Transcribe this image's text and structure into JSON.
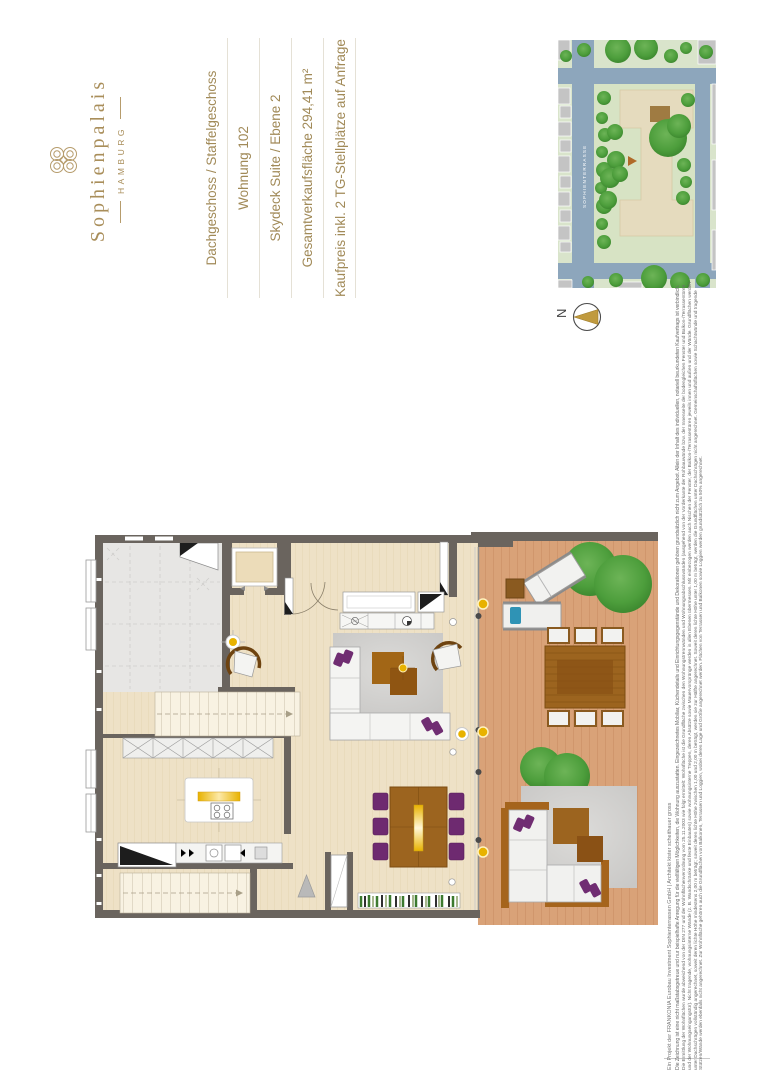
{
  "branding": {
    "name": "Sophienpalais",
    "city": "HAMBURG",
    "brand_color": "#a98e5a",
    "ornament_icon": "scroll-quatrefoil-monogram"
  },
  "info_panel": {
    "orientation": "rotated-90-ccw",
    "lines": [
      "Dachgeschoss / Staffelgeschoss",
      "Wohnung 102",
      "Skydeck Suite / Ebene 2",
      "Gesamtverkaufsfläche 294,41 m²",
      "Kaufpreis inkl. 2 TG-Stellplätze auf Anfrage"
    ]
  },
  "site_map": {
    "street_label": "SOPHIENTERRASSE",
    "marker_icon": "location-triangle",
    "colors": {
      "lawn": "#d9e4cb",
      "street": "#8da6bc",
      "building_gray": "#c4c4c4",
      "building_main": "#e5dbbe",
      "unit_highlight": "#9f7b42",
      "tree": "#4d9e3c"
    }
  },
  "compass": {
    "north_label": "N",
    "needle_color": "#c09a3e"
  },
  "floor_plan": {
    "colors": {
      "wall": "#6a645e",
      "floor_wood": "#eee1c6",
      "room_gray": "#e7e6e4",
      "terrace_deck": "#d9a278",
      "furniture_brown": "#9c641f",
      "accent_purple": "#702d72",
      "accent_gold": "#e8b200",
      "rug_gray": "#d6d5d3"
    },
    "elements": [
      "elevator",
      "upper-staircase",
      "lower-staircase",
      "wardrobe-row",
      "kitchen-island-with-cooktop",
      "kitchen-counter",
      "sofa-with-rug-and-coffee-table",
      "lounge-armchair",
      "dining-table-with-six-chairs",
      "pendant-light",
      "bookshelf",
      "ceiling-lights",
      "roof-terrace-deck",
      "sun-loungers",
      "outdoor-dining-set",
      "outdoor-lounge-set",
      "terrace-trees"
    ]
  },
  "disclaimer": {
    "project": "Ein Projekt der FRANKONIA Eurobau Investment Sophienterrassen GmbH | Architekt kister scheithauer gross",
    "usage": "Die Zeichnung ist eine nicht maßstabsgetreue und nur beispielhafte Anregung für die vielfältigen Möglichkeiten, die Wohnung auszustatten. Eingezeichnetes Mobiliar, Küchendetails und Einrichtungsgegenstände und Dekorationen gehören grundsätzlich nicht zum Angebot. Allein der Inhalt des individuellen, notariell beurkundeten Kaufvertrags ist verbindlich.",
    "area_calculation": "Die Ermittlung der Wohnflächen wurde abweichend von der DIN 277 und der Wohnflächenverordnung vom 25.11.2003 wie folgt ermittelt: Wohnfläche ist die Grundfläche zwischen den Wohnungstrennwänden und Wohnungsabschlusswänden (ausgehend von der Vorderkante der Rohbauwände bzw. der Innenseite der bodengleichen Fenster und Balkon-/Terrassentüren und der Wohnungseingangstür). Nicht tragende, wohnungsinterne Wände (z. B. Wandschränke und feste Einbauten) sowie wohnungsinterne Treppen, deren Absätze sowie Mauervorsprünge werden in allen Ebenen übermessen. Mit einbezogen werden auch Nischen der Fenster, der Balkon-/Terrassentüren jeweils innen und außen und der Wände. Grundflächen werden unter Dachschrägen vollständig angerechnet, soweit deren lichte Höhe mindestens 2,00 m beträgt; soweit deren lichte Höhe zwischen 1,00 und 2,00 m beträgt, werden sie zur Hälfte angerechnet. Soweit deren lichte Höhe unter 1,00 m beträgt, werden die Grundflächen unter Dachschrägen nicht angerechnet. Gemeinschaftsflächen sowie Schachtwände und tragende Stützen/Wände werden ebenfalls nicht angerechnet. Zur Wohnfläche gehören auch die Grundflächen von Balkonen, Terrassen und Loggien, wobei deren Lage und Größe angerechnet werden. Flächen von Terrassen und Balkonen sowie Loggien werden grundsätzlich zu 50% angerechnet."
  }
}
